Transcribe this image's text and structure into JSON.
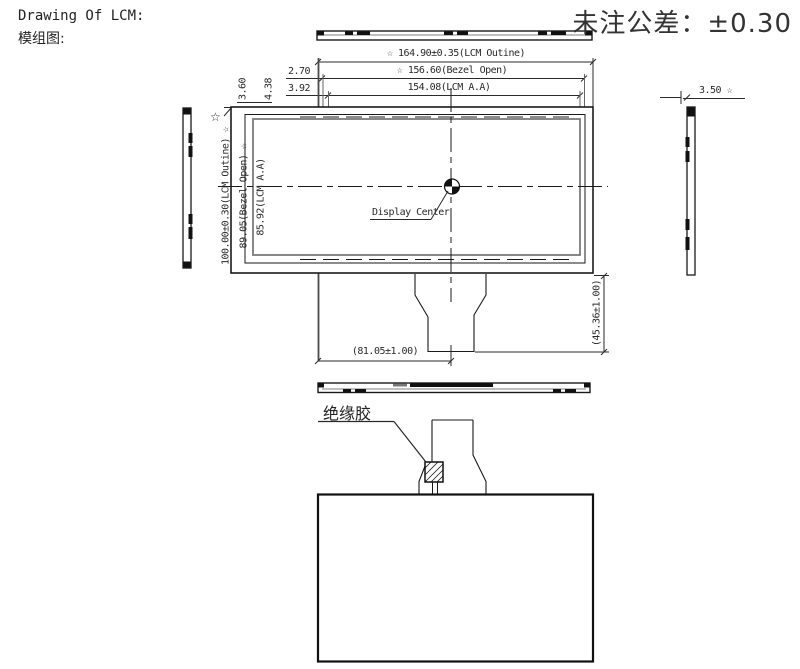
{
  "header": {
    "title_en": "Drawing Of  LCM:",
    "title_cn": "模组图:",
    "tolerance": "未注公差：±0.30"
  },
  "dimensions": {
    "lcm_outline_w": "☆ 164.90±0.35(LCM Outine)",
    "bezel_open_w": "☆   156.60(Bezel Open)",
    "aa_w": "154.08(LCM A.A)",
    "top_gap_1": "2.70",
    "top_gap_2": "3.92",
    "left_gap_1": "3.60",
    "left_gap_2": "4.38",
    "lcm_outline_h": "100.00±0.30(LCM Outine) ☆",
    "bezel_open_h": "89.05(Bezel Open) ☆",
    "aa_h": "85.92(LCM A.A)",
    "thickness": "3.50 ☆",
    "fpc_center_offset": "(81.05±1.00)",
    "fpc_length": "(45.36±1.00)"
  },
  "labels": {
    "display_center": "Display Center",
    "insulation_glue": "绝缘胶",
    "star_marker": "☆"
  },
  "icons": {
    "star_icon": "☆",
    "center_mark_icon": "quadrant-circle"
  },
  "colors": {
    "line": "#1a1a1a",
    "gray_line": "#7b7b7b",
    "background": "#ffffff"
  }
}
